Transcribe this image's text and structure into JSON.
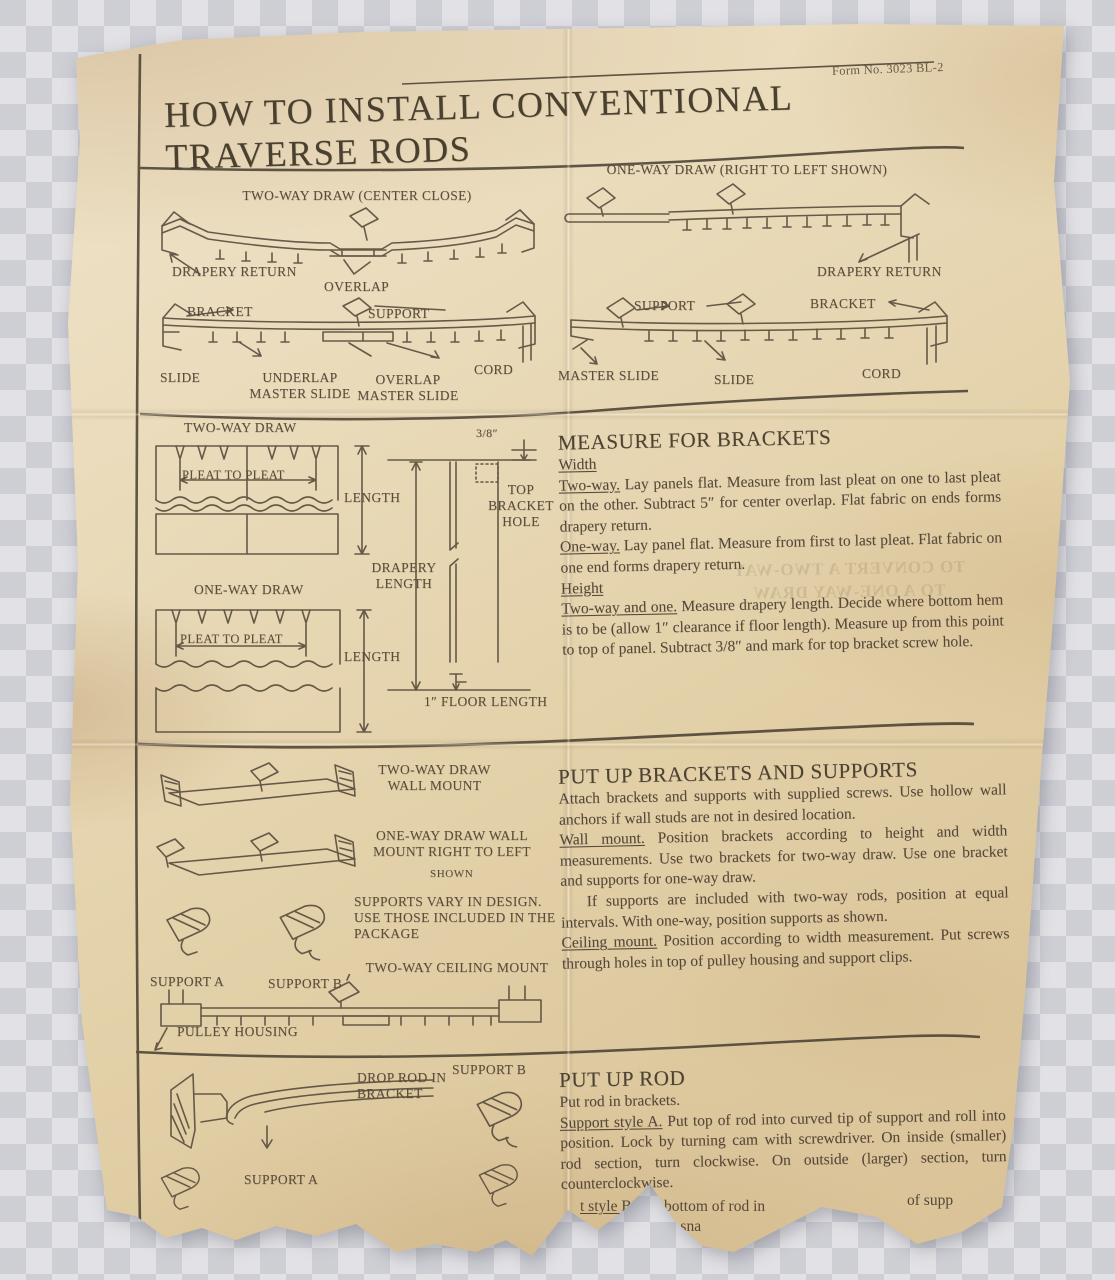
{
  "header": {
    "form_no": "Form No. 3023 BL-2",
    "title_line1": "HOW TO INSTALL CONVENTIONAL",
    "title_line2": "TRAVERSE RODS"
  },
  "rod_overview": {
    "two_way_title": "TWO-WAY DRAW (CENTER CLOSE)",
    "one_way_title": "ONE-WAY DRAW (RIGHT TO LEFT SHOWN)",
    "drapery_return": "DRAPERY RETURN",
    "overlap": "OVERLAP",
    "bracket": "BRACKET",
    "support": "SUPPORT",
    "slide": "SLIDE",
    "underlap_master_slide": "UNDERLAP MASTER SLIDE",
    "overlap_master_slide": "OVERLAP MASTER SLIDE",
    "master_slide": "MASTER SLIDE",
    "cord": "CORD"
  },
  "measure": {
    "heading": "MEASURE FOR BRACKETS",
    "width_label": "Width",
    "two_way_lead": "Two-way.",
    "two_way_text": " Lay panels flat. Measure from last pleat on one to last pleat on the other. Subtract 5″ for center overlap. Flat fabric on ends forms drapery return.",
    "one_way_lead": "One-way.",
    "one_way_text": " Lay panel flat. Measure from first to last pleat. Flat fabric on one end forms drapery return.",
    "height_label": "Height",
    "height_lead": "Two-way and one.",
    "height_text": " Measure drapery length. Decide where bottom hem is to be (allow 1″ clearance if floor length). Measure up from this point to top of panel. Subtract 3/8″ and mark for top bracket screw hole.",
    "diagram": {
      "two_way": "TWO-WAY DRAW",
      "one_way": "ONE-WAY DRAW",
      "pleat_to_pleat": "PLEAT TO PLEAT",
      "length": "LENGTH",
      "drapery_length": "DRAPERY LENGTH",
      "top_bracket_hole": "TOP BRACKET HOLE",
      "three_eighths": "3/8″",
      "floor_length": "1″ FLOOR LENGTH"
    }
  },
  "brackets_section": {
    "heading": "PUT UP BRACKETS AND SUPPORTS",
    "p1": "Attach brackets and supports with supplied screws. Use hollow wall anchors if wall studs are not in desired location.",
    "wall_lead": "Wall mount.",
    "wall_text": " Position brackets according to height and width measurements. Use two brackets for two-way draw. Use one bracket and supports for one-way draw.",
    "p2": "If supports are included with two-way rods, position at equal intervals. With one-way, position supports as shown.",
    "ceiling_lead": "Ceiling mount.",
    "ceiling_text": " Position according to width measurement. Put screws through holes in top of pulley housing and support clips.",
    "diagram": {
      "two_way_wall": "TWO-WAY DRAW WALL MOUNT",
      "one_way_wall": "ONE-WAY DRAW WALL MOUNT RIGHT TO LEFT",
      "shown": "SHOWN",
      "supports_vary": "SUPPORTS VARY IN DESIGN. USE THOSE INCLUDED IN THE PACKAGE",
      "support_a": "SUPPORT A",
      "support_b": "SUPPORT B",
      "ceiling": "TWO-WAY CEILING MOUNT",
      "pulley_housing": "PULLEY HOUSING"
    }
  },
  "rod_section": {
    "heading": "PUT UP ROD",
    "p1": "Put rod in brackets.",
    "style_a_lead": "Support style A.",
    "style_a_text": " Put top of rod into curved tip of support and roll into position. Lock by turning cam with screwdriver. On inside (smaller) rod section, turn clockwise. On outside (larger) section, turn counterclockwise.",
    "style_b_lead": "t style B.",
    "style_b_text": " Put bottom of rod in",
    "style_b_frag_right": "of supp",
    "style_b_frag2": "d until it sna",
    "style_b_frag3": "ction",
    "diagram": {
      "drop_rod": "DROP ROD IN BRACKET",
      "support_a": "SUPPORT A",
      "support_b": "SUPPORT B"
    }
  },
  "ghost": {
    "line1": "TO CONVERT A TWO-WAY",
    "line2": "TO A ONE-WAY DRAW"
  }
}
